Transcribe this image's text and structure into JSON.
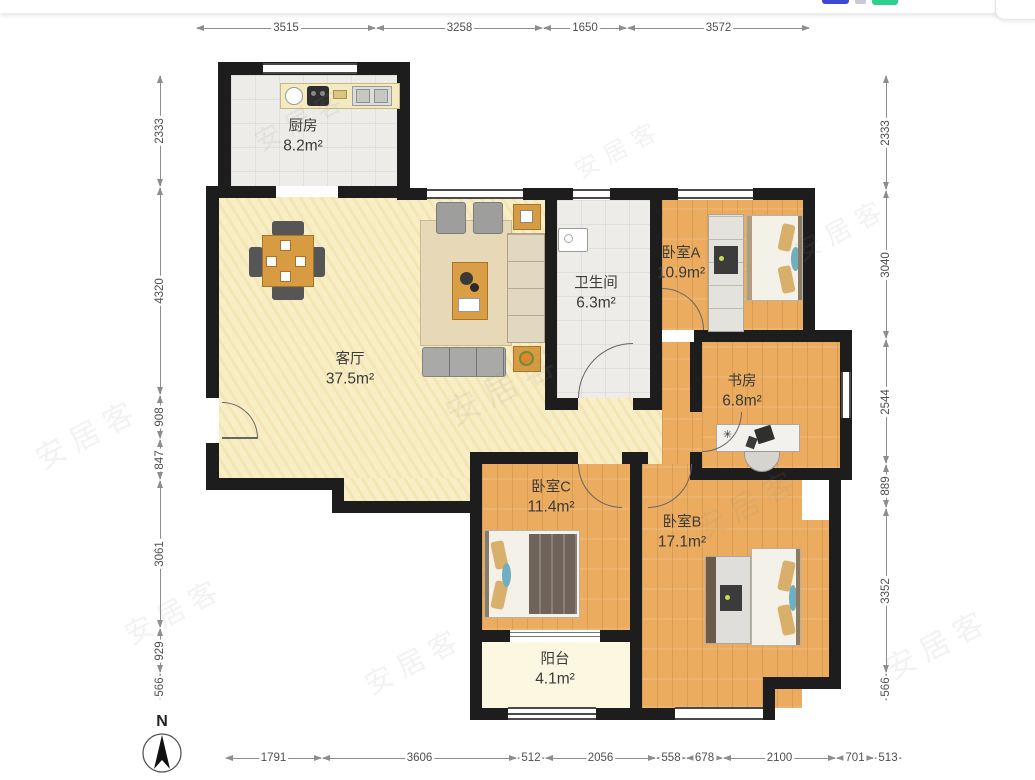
{
  "watermark": "安居客",
  "compass": {
    "label": "N"
  },
  "rooms": {
    "kitchen": {
      "name": "厨房",
      "area": "8.2m²"
    },
    "living": {
      "name": "客厅",
      "area": "37.5m²"
    },
    "bath": {
      "name": "卫生间",
      "area": "6.3m²"
    },
    "bedroomA": {
      "name": "卧室A",
      "area": "10.9m²"
    },
    "study": {
      "name": "书房",
      "area": "6.8m²"
    },
    "bedroomC": {
      "name": "卧室C",
      "area": "11.4m²"
    },
    "bedroomB": {
      "name": "卧室B",
      "area": "17.1m²"
    },
    "balcony": {
      "name": "阳台",
      "area": "4.1m²"
    }
  },
  "dimensions": {
    "top": [
      "3515",
      "3258",
      "1650",
      "3572"
    ],
    "left": [
      "2333",
      "4320",
      "908",
      "847",
      "3061",
      "929",
      "566"
    ],
    "right": [
      "2333",
      "3040",
      "2544",
      "889",
      "3352",
      "566"
    ],
    "bottom": [
      "1791",
      "3606",
      "512",
      "2056",
      "558",
      "678",
      "2100",
      "701",
      "513"
    ]
  },
  "colors": {
    "wall": "#1d1d1d",
    "wood_floor": "#EBAC5F",
    "living_floor": "#F8EEC5",
    "tile_floor": "#EDECE9",
    "balcony_floor": "#FBF7E0",
    "accent_blue": "#4147d5",
    "accent_green": "#2fd08d"
  }
}
